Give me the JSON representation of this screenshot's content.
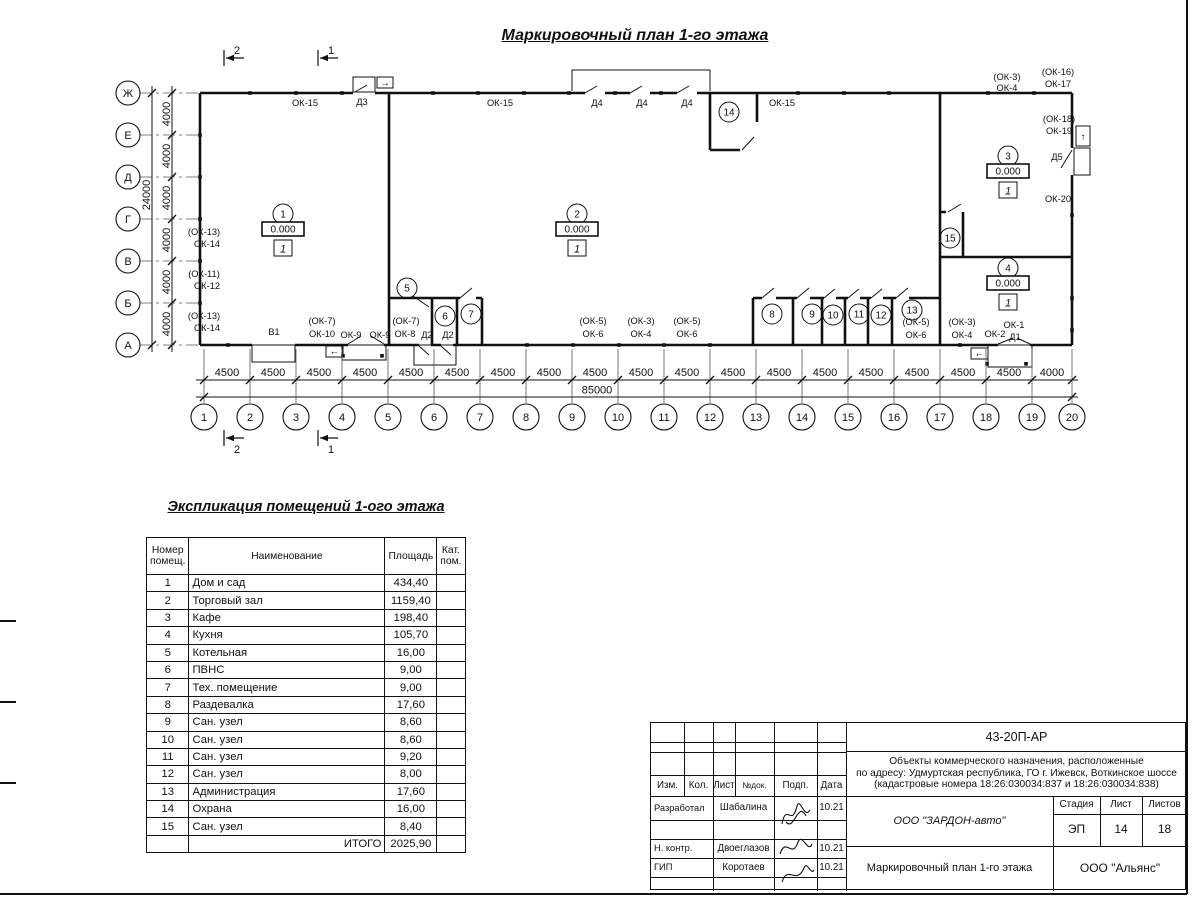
{
  "colors": {
    "ink": "#111111",
    "paper": "#ffffff"
  },
  "sheet": {
    "plan_title": "Маркировочный план 1-го этажа",
    "table_title": "Экспликация помещений 1-ого этажа"
  },
  "plan": {
    "grid": {
      "left_axes": [
        {
          "label": "Ж",
          "y": 93
        },
        {
          "label": "Е",
          "y": 135
        },
        {
          "label": "Д",
          "y": 177
        },
        {
          "label": "Г",
          "y": 219
        },
        {
          "label": "В",
          "y": 261
        },
        {
          "label": "Б",
          "y": 303
        },
        {
          "label": "А",
          "y": 345
        }
      ],
      "left_dim_values": [
        "4000",
        "4000",
        "4000",
        "4000",
        "4000",
        "4000"
      ],
      "left_dim_total": "24000",
      "bottom_axes": [
        {
          "label": "1",
          "x": 204
        },
        {
          "label": "2",
          "x": 250
        },
        {
          "label": "3",
          "x": 296
        },
        {
          "label": "4",
          "x": 342
        },
        {
          "label": "5",
          "x": 388
        },
        {
          "label": "6",
          "x": 434
        },
        {
          "label": "7",
          "x": 480
        },
        {
          "label": "8",
          "x": 526
        },
        {
          "label": "9",
          "x": 572
        },
        {
          "label": "10",
          "x": 618
        },
        {
          "label": "11",
          "x": 664
        },
        {
          "label": "12",
          "x": 710
        },
        {
          "label": "13",
          "x": 756
        },
        {
          "label": "14",
          "x": 802
        },
        {
          "label": "15",
          "x": 848
        },
        {
          "label": "16",
          "x": 894
        },
        {
          "label": "17",
          "x": 940
        },
        {
          "label": "18",
          "x": 986
        },
        {
          "label": "19",
          "x": 1032
        },
        {
          "label": "20",
          "x": 1072
        }
      ],
      "bottom_dim_values": [
        "4500",
        "4500",
        "4500",
        "4500",
        "4500",
        "4500",
        "4500",
        "4500",
        "4500",
        "4500",
        "4500",
        "4500",
        "4500",
        "4500",
        "4500",
        "4500",
        "4500",
        "4500",
        "4000"
      ],
      "bottom_dim_total": "85000"
    },
    "section_marks": [
      {
        "label": "2",
        "x": 224,
        "y": 58,
        "below": false
      },
      {
        "label": "1",
        "x": 318,
        "y": 58,
        "below": false
      },
      {
        "label": "2",
        "x": 224,
        "y": 438,
        "below": true
      },
      {
        "label": "1",
        "x": 318,
        "y": 438,
        "below": true
      }
    ],
    "room_markers": [
      {
        "num": "1",
        "elev": "0.000",
        "floor": "1",
        "x": 283,
        "y": 214
      },
      {
        "num": "2",
        "elev": "0.000",
        "floor": "1",
        "x": 577,
        "y": 214
      },
      {
        "num": "3",
        "elev": "0.000",
        "floor": "1",
        "x": 1008,
        "y": 156
      },
      {
        "num": "4",
        "elev": "0.000",
        "floor": "1",
        "x": 1008,
        "y": 268
      }
    ],
    "room_circles": [
      {
        "num": "5",
        "x": 407,
        "y": 288
      },
      {
        "num": "6",
        "x": 445,
        "y": 316
      },
      {
        "num": "7",
        "x": 471,
        "y": 314
      },
      {
        "num": "8",
        "x": 772,
        "y": 314
      },
      {
        "num": "9",
        "x": 812,
        "y": 314
      },
      {
        "num": "10",
        "x": 833,
        "y": 315
      },
      {
        "num": "11",
        "x": 859,
        "y": 314
      },
      {
        "num": "12",
        "x": 881,
        "y": 315
      },
      {
        "num": "13",
        "x": 912,
        "y": 310
      },
      {
        "num": "14",
        "x": 729,
        "y": 112
      },
      {
        "num": "15",
        "x": 950,
        "y": 238
      }
    ],
    "wall_labels": [
      {
        "t": "ОК-15",
        "x": 305,
        "y": 106
      },
      {
        "t": "Д3",
        "x": 362,
        "y": 105
      },
      {
        "t": "ОК-15",
        "x": 500,
        "y": 106
      },
      {
        "t": "Д4",
        "x": 597,
        "y": 106
      },
      {
        "t": "Д4",
        "x": 642,
        "y": 106
      },
      {
        "t": "Д4",
        "x": 687,
        "y": 106
      },
      {
        "t": "ОК-15",
        "x": 782,
        "y": 106
      },
      {
        "t": "(ОК-3)",
        "x": 1007,
        "y": 80
      },
      {
        "t": "ОК-4",
        "x": 1007,
        "y": 91
      },
      {
        "t": "(ОК-16)",
        "x": 1058,
        "y": 75
      },
      {
        "t": "ОК-17",
        "x": 1058,
        "y": 87
      },
      {
        "t": "(ОК-18)",
        "x": 1059,
        "y": 122
      },
      {
        "t": "ОК-19",
        "x": 1059,
        "y": 134
      },
      {
        "t": "Д5",
        "x": 1057,
        "y": 160
      },
      {
        "t": "ОК-20",
        "x": 1058,
        "y": 202
      },
      {
        "t": "(ОК-13)",
        "x": 204,
        "y": 235,
        "a": "s"
      },
      {
        "t": "ОК-14",
        "x": 207,
        "y": 247,
        "a": "s"
      },
      {
        "t": "(ОК-11)",
        "x": 204,
        "y": 277,
        "a": "s"
      },
      {
        "t": "ОК-12",
        "x": 207,
        "y": 289,
        "a": "s"
      },
      {
        "t": "(ОК-13)",
        "x": 204,
        "y": 319,
        "a": "s"
      },
      {
        "t": "ОК-14",
        "x": 207,
        "y": 331,
        "a": "s"
      },
      {
        "t": "В1",
        "x": 274,
        "y": 335
      },
      {
        "t": "(ОК-7)",
        "x": 322,
        "y": 324
      },
      {
        "t": "ОК-10",
        "x": 322,
        "y": 337
      },
      {
        "t": "ОК-9",
        "x": 351,
        "y": 338
      },
      {
        "t": "ОК-9",
        "x": 380,
        "y": 338
      },
      {
        "t": "(ОК-7)",
        "x": 406,
        "y": 324
      },
      {
        "t": "ОК-8",
        "x": 405,
        "y": 337
      },
      {
        "t": "Д2",
        "x": 427,
        "y": 338
      },
      {
        "t": "Д2",
        "x": 448,
        "y": 338
      },
      {
        "t": "(ОК-5)",
        "x": 593,
        "y": 324
      },
      {
        "t": "ОК-6",
        "x": 593,
        "y": 337
      },
      {
        "t": "(ОК-3)",
        "x": 641,
        "y": 324
      },
      {
        "t": "ОК-4",
        "x": 641,
        "y": 337
      },
      {
        "t": "(ОК-5)",
        "x": 687,
        "y": 324
      },
      {
        "t": "ОК-6",
        "x": 687,
        "y": 337
      },
      {
        "t": "(ОК-5)",
        "x": 916,
        "y": 325
      },
      {
        "t": "ОК-6",
        "x": 916,
        "y": 338
      },
      {
        "t": "(ОК-3)",
        "x": 962,
        "y": 325
      },
      {
        "t": "ОК-4",
        "x": 962,
        "y": 338
      },
      {
        "t": "ОК-2",
        "x": 995,
        "y": 337
      },
      {
        "t": "ОК-1",
        "x": 1014,
        "y": 328
      },
      {
        "t": "Д1",
        "x": 1015,
        "y": 340
      }
    ],
    "arrows": [
      {
        "glyph": "→",
        "x": 385,
        "y": 86
      },
      {
        "glyph": "↑",
        "x": 1083,
        "y": 140
      },
      {
        "glyph": "←",
        "x": 334.5,
        "y": 354.5
      },
      {
        "glyph": "←",
        "x": 979.5,
        "y": 356.5
      }
    ]
  },
  "table": {
    "headers": [
      "Номер помещ.",
      "Наименование",
      "Площадь",
      "Кат. пом."
    ],
    "rows": [
      [
        "1",
        "Дом и сад",
        "434,40"
      ],
      [
        "2",
        "Торговый зал",
        "1159,40"
      ],
      [
        "3",
        "Кафе",
        "198,40"
      ],
      [
        "4",
        "Кухня",
        "105,70"
      ],
      [
        "5",
        "Котельная",
        "16,00"
      ],
      [
        "6",
        "ПВНС",
        "9,00"
      ],
      [
        "7",
        "Тех. помещение",
        "9,00"
      ],
      [
        "8",
        "Раздевалка",
        "17,60"
      ],
      [
        "9",
        "Сан. узел",
        "8,60"
      ],
      [
        "10",
        "Сан. узел",
        "8,60"
      ],
      [
        "11",
        "Сан. узел",
        "9,20"
      ],
      [
        "12",
        "Сан. узел",
        "8,00"
      ],
      [
        "13",
        "Администрация",
        "17,60"
      ],
      [
        "14",
        "Охрана",
        "16,00"
      ],
      [
        "15",
        "Сан. узел",
        "8,40"
      ]
    ],
    "total_label": "ИТОГО",
    "total_value": "2025,90"
  },
  "title_block": {
    "code": "43-20П-АР",
    "description_lines": [
      "Объекты коммерческого назначения, расположенные",
      "по адресу: Удмуртская республика, ГО г. Ижевск, Воткинское шоссе",
      "(кадастровые номера 18:26:030034:837 и 18:26:030034:838)"
    ],
    "header_cells": [
      "Изм.",
      "Кол.",
      "Лист",
      "№док.",
      "Подп.",
      "Дата"
    ],
    "people": [
      {
        "role": "Разработал",
        "name": "Шабалина",
        "date": "10.21"
      },
      {
        "role": "Н. контр.",
        "name": "Двоеглазов",
        "date": "10.21"
      },
      {
        "role": "ГИП",
        "name": "Коротаев",
        "date": "10.21"
      }
    ],
    "company": "ООО \"ЗАРДОН-авто\"",
    "doc_title": "Маркировочный план 1-го этажа",
    "firm": "ООО \"Альянс\"",
    "stage_header": [
      "Стадия",
      "Лист",
      "Листов"
    ],
    "stage_values": [
      "ЭП",
      "14",
      "18"
    ]
  }
}
